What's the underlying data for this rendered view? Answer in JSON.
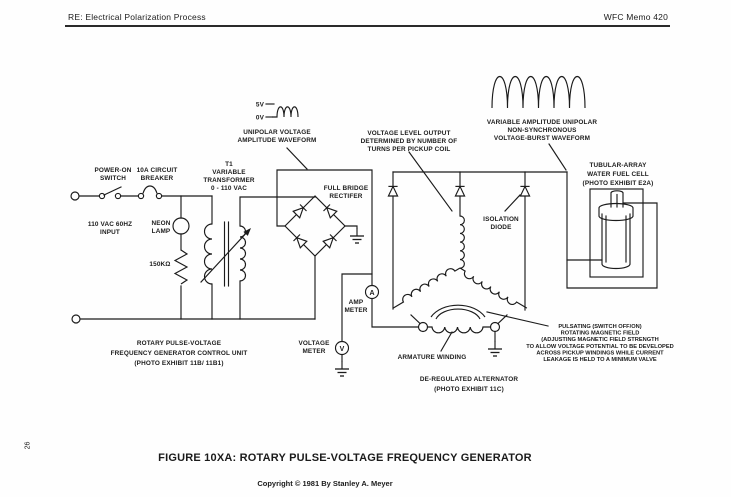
{
  "page": {
    "header_left": "RE: Electrical Polarization Process",
    "header_right": "WFC Memo 420",
    "page_number": "26",
    "caption": "FIGURE 10XA: ROTARY PULSE-VOLTAGE FREQUENCY GENERATOR",
    "copyright": "Copyright © 1981 By Stanley A. Meyer"
  },
  "colors": {
    "ink": "#1b1b1b",
    "paper": "#fefefe"
  },
  "labels": {
    "power_switch": [
      "POWER-ON",
      "SWITCH"
    ],
    "breaker": [
      "10A CIRCUIT",
      "BREAKER"
    ],
    "t1": [
      "T1",
      "VARIABLE",
      "TRANSFORMER",
      "0 - 110 VAC"
    ],
    "input": [
      "110 VAC 60HZ",
      "INPUT"
    ],
    "neon": [
      "NEON",
      "LAMP"
    ],
    "resistor": "150KΩ",
    "bridge": [
      "FULL BRIDGE",
      "RECTIFER"
    ],
    "wave5v": "5V",
    "wave0v": "0V",
    "unipolar_wave": [
      "UNIPOLAR VOLTAGE",
      "AMPLITUDE WAVEFORM"
    ],
    "voltage_level": [
      "VOLTAGE LEVEL OUTPUT",
      "DETERMINED BY NUMBER OF",
      "TURNS PER PICKUP COIL"
    ],
    "burst_wave": [
      "VARIABLE AMPLITUDE UNIPOLAR",
      "NON-SYNCHRONOUS",
      "VOLTAGE-BURST WAVEFORM"
    ],
    "isolation": [
      "ISOLATION",
      "DIODE"
    ],
    "fuel_cell": [
      "TUBULAR-ARRAY",
      "WATER FUEL CELL",
      "(PHOTO EXHIBIT E2A)"
    ],
    "amp_meter": [
      "AMP",
      "METER"
    ],
    "amp_symbol": "A",
    "volt_meter": [
      "VOLTAGE",
      "METER"
    ],
    "volt_symbol": "V",
    "control_unit": [
      "ROTARY PULSE-VOLTAGE",
      "FREQUENCY GENERATOR CONTROL UNIT",
      "(PHOTO EXHIBIT 11B/ 11B1)"
    ],
    "armature": "ARMATURE WINDING",
    "alternator": [
      "DE-REGULATED ALTERNATOR",
      "(PHOTO EXHIBIT 11C)"
    ],
    "pulsating": [
      "PULSATING (SWITCH OFF/ON)",
      "ROTATING MAGNETIC FIELD",
      "(ADJUSTING MAGNETIC FIELD STRENGTH",
      "TO ALLOW VOLTAGE POTENTIAL TO BE DEVELOPED",
      "ACROSS PICKUP WINDINGS WHILE CURRENT",
      "LEAKAGE IS HELD TO A MINIMUM VALVE"
    ]
  }
}
